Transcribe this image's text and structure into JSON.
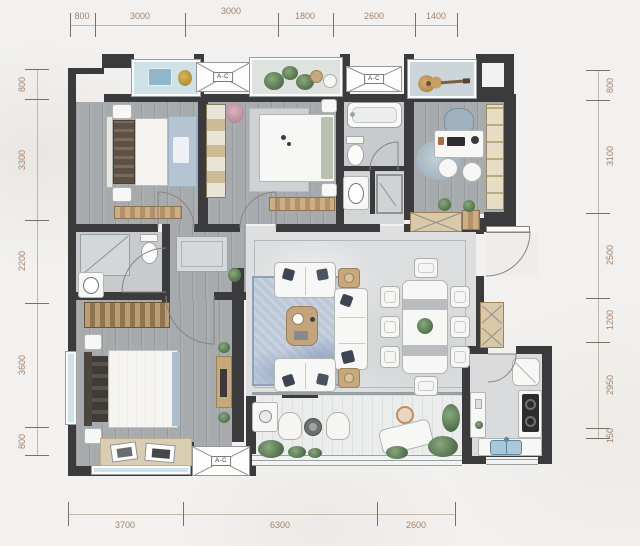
{
  "dimensions": {
    "top": [
      "800",
      "3000",
      "3000",
      "1800",
      "2600",
      "1400"
    ],
    "bottom": [
      "3700",
      "6300",
      "2600"
    ],
    "left": [
      "800",
      "3300",
      "2200",
      "3600",
      "800"
    ],
    "right": [
      "800",
      "3100",
      "2500",
      "1200",
      "2950",
      "150"
    ]
  },
  "labels": {
    "ac_unit": "A-C"
  },
  "colors": {
    "wall": "#3b3b3d",
    "dimension_text": "#a5826a",
    "wood_floor": "#a7abad",
    "marble_floor": "#dcdedf",
    "bath_floor": "#c8cbcd",
    "balcony_tile": "#ebecec",
    "furniture_wood": "#c7a87d",
    "rug_blue": "#b4c1d4",
    "window_glass": "#cfe2e7",
    "plant_green": "#4e6d4a"
  }
}
